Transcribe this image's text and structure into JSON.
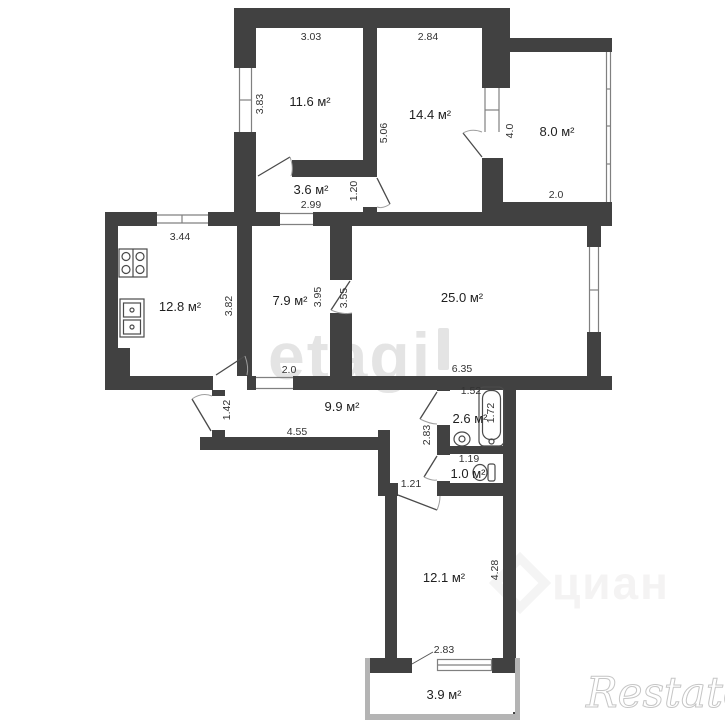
{
  "rooms": {
    "r116": "11.6 м²",
    "r144": "14.4 м²",
    "r80": "8.0 м²",
    "r36": "3.6 м²",
    "r128": "12.8 м²",
    "r79": "7.9 м²",
    "r250": "25.0 м²",
    "r99": "9.9 м²",
    "r26": "2.6 м²",
    "r10": "1.0 м²",
    "r121": "12.1 м²",
    "r39": "3.9 м²"
  },
  "dims": {
    "d303": "3.03",
    "d284": "2.84",
    "d383": "3.83",
    "d506": "5.06",
    "d40": "4.0",
    "d20top": "2.0",
    "d299": "2.99",
    "d120": "1.20",
    "d344": "3.44",
    "d382": "3.82",
    "d395": "3.95",
    "d355": "3.55",
    "d635": "6.35",
    "d20mid": "2.0",
    "d142": "1.42",
    "d455": "4.55",
    "d283v": "2.83",
    "d152": "1.52",
    "d172": "1.72",
    "d119": "1.19",
    "d121": "1.21",
    "d428": "4.28",
    "d283b": "2.83"
  },
  "watermarks": {
    "etagi": "etagi",
    "cian": "циан",
    "restate": "Restate"
  },
  "colors": {
    "wall": "#414141",
    "light_wall": "#b4b4b4"
  }
}
